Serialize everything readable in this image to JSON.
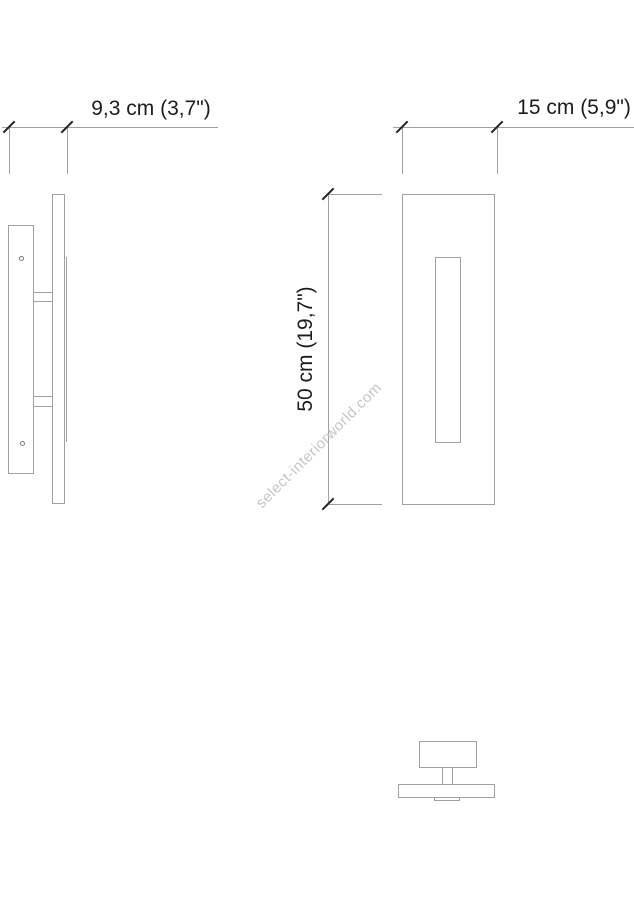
{
  "drawing": {
    "type": "wall-lamp-technical-drawing",
    "dimensions": {
      "depth": "9,3 cm (3,7\")",
      "width": "15 cm (5,9\")",
      "height": "50 cm (19,7\")"
    },
    "watermark": "select-interiorworld.com",
    "colors": {
      "background": "#ffffff",
      "drawing_line": "#a0a0a0",
      "dimension_tick": "#222222",
      "dimension_text": "#1c1c1c",
      "watermark_text": "#c6c6c6"
    }
  }
}
